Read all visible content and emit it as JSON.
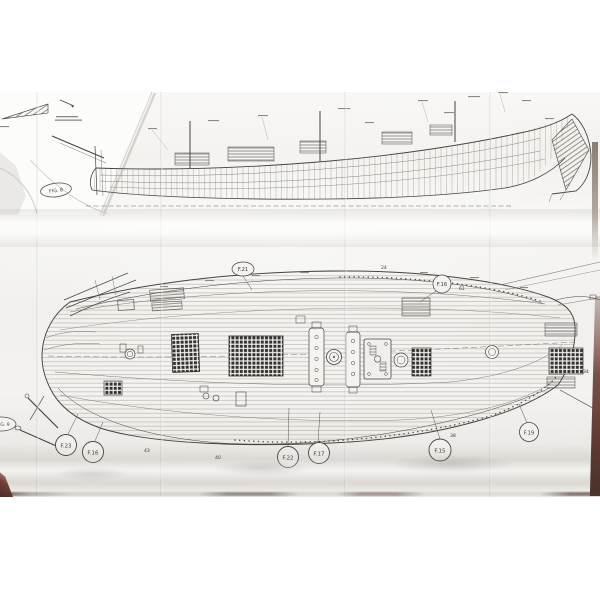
{
  "elevation": {
    "fig_stamp": "FIG. 8"
  },
  "deck": {
    "labels": [
      {
        "id": "f21",
        "text": "F.21"
      },
      {
        "id": "f16-top",
        "text": "F.16"
      },
      {
        "id": "fig9",
        "text": "FIG. 9"
      },
      {
        "id": "f23",
        "text": "F.23"
      },
      {
        "id": "f16-bottom",
        "text": "F.16"
      },
      {
        "id": "f22",
        "text": "F.22"
      },
      {
        "id": "f17",
        "text": "F.17"
      },
      {
        "id": "f15",
        "text": "F.15"
      },
      {
        "id": "f19",
        "text": "F.19"
      }
    ],
    "numbers": {
      "n61": "61",
      "n24": "24",
      "n38": "38",
      "n43": "43",
      "n40": "40",
      "n34": "34"
    }
  },
  "colors": {
    "ink": "#45433f",
    "paper": "#f1efeb",
    "table_edge": "#5d3a33"
  }
}
